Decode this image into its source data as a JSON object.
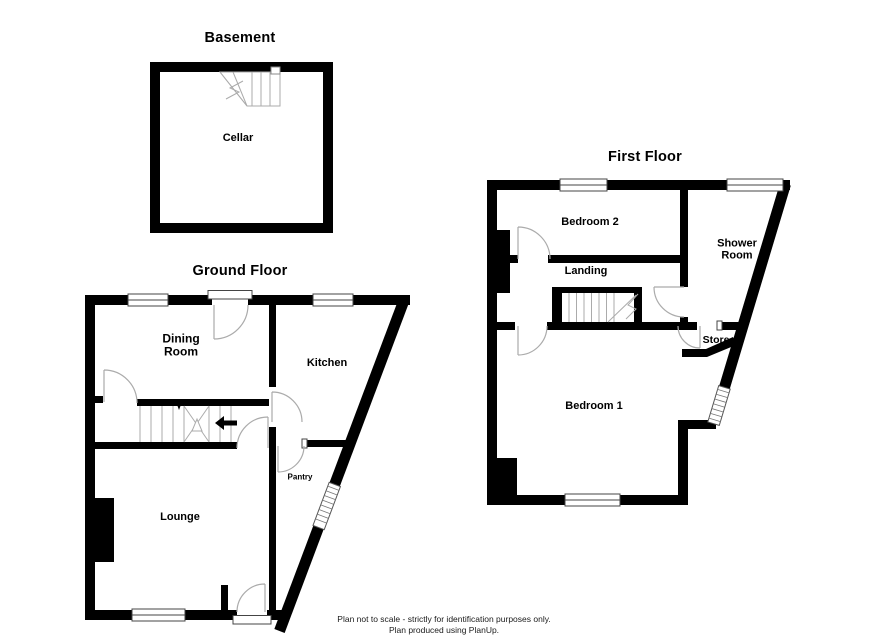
{
  "plan": {
    "floors": [
      {
        "name": "Basement",
        "rooms": [
          {
            "label": "Cellar"
          }
        ]
      },
      {
        "name": "Ground Floor",
        "rooms": [
          {
            "label": "Dining Room"
          },
          {
            "label": "Kitchen"
          },
          {
            "label": "Lounge"
          },
          {
            "label": "Pantry"
          }
        ]
      },
      {
        "name": "First Floor",
        "rooms": [
          {
            "label": "Bedroom 2"
          },
          {
            "label": "Shower Room"
          },
          {
            "label": "Landing"
          },
          {
            "label": "Store"
          },
          {
            "label": "Bedroom 1"
          }
        ]
      }
    ],
    "footer": {
      "line1": "Plan not to scale - strictly for identification purposes only.",
      "line2": "Plan produced using PlanUp."
    },
    "colors": {
      "wall": "#000000",
      "fixture_line": "#ababab",
      "window_outline": "#444444",
      "background": "#ffffff"
    }
  }
}
